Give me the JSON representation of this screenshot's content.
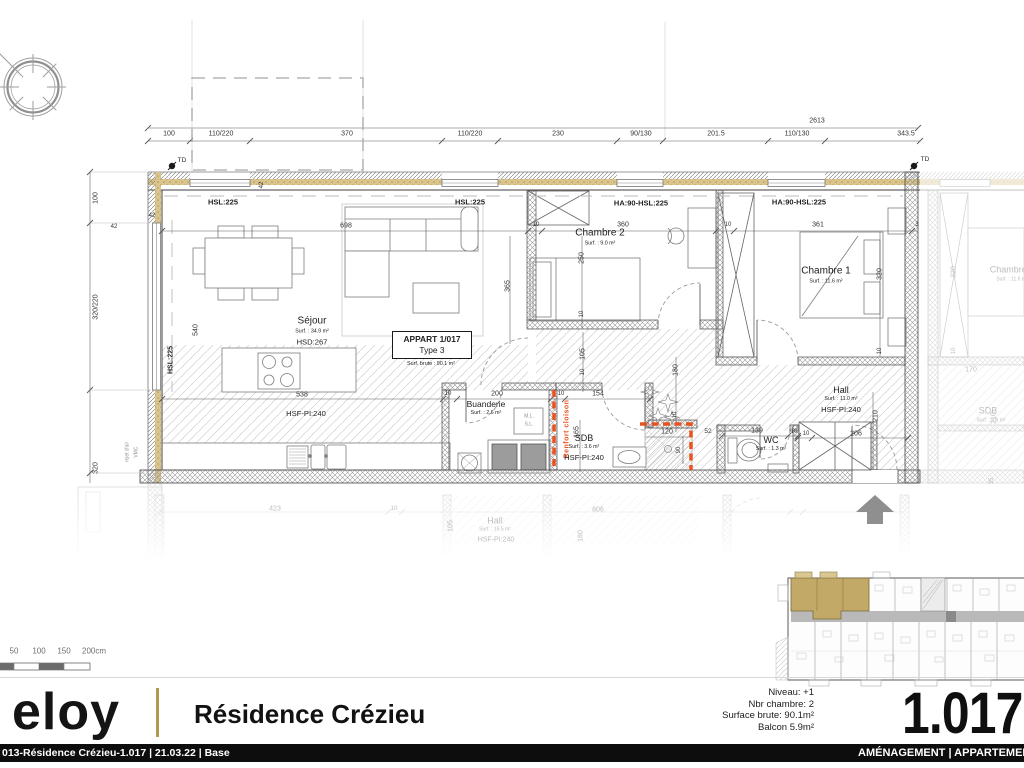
{
  "colors": {
    "accent_red": "#e8521f",
    "insulation": "#d8c48c",
    "keyplan_gold": "#c2a968",
    "title_gold": "#b09a52"
  },
  "plan": {
    "appart_box": {
      "line1": "APPART 1/017",
      "line2": "Type 3",
      "line3": "Surf. brute : 90.1 m²"
    },
    "rooms": [
      {
        "id": "sejour",
        "name": "Séjour",
        "surface": "Surf. : 34.9 m²",
        "extra": "HSD:267",
        "x": 312,
        "y": 331,
        "ns": 10
      },
      {
        "id": "chambre2",
        "name": "Chambre 2",
        "surface": "Surf. : 9.0 m²",
        "x": 600,
        "y": 237,
        "ns": 10
      },
      {
        "id": "chambre1",
        "name": "Chambre 1",
        "surface": "Surf. : 11.6 m²",
        "x": 826,
        "y": 275,
        "ns": 10
      },
      {
        "id": "buanderie",
        "name": "Buanderie",
        "surface": "Surf. : 2.6 m²",
        "x": 486,
        "y": 408,
        "ns": 8.5
      },
      {
        "id": "sdb",
        "name": "SDB",
        "surface": "Surf. : 3.6 m²",
        "extra": "HSF-PI:240",
        "x": 584,
        "y": 448,
        "ns": 9
      },
      {
        "id": "wc",
        "name": "WC",
        "surface": "Surf. : 1.3 m²",
        "x": 771,
        "y": 444,
        "ns": 9
      },
      {
        "id": "hall",
        "name": "Hall",
        "surface": "Surf. : 11.0 m²",
        "extra": "HSF-PI:240",
        "x": 841,
        "y": 400,
        "ns": 9
      }
    ],
    "window_labels": [
      {
        "t": "HSL:225",
        "x": 223,
        "y": 202,
        "s": 7.5
      },
      {
        "t": "HSL:225",
        "x": 470,
        "y": 202,
        "s": 7.5
      },
      {
        "t": "HA:90-HSL:225",
        "x": 641,
        "y": 203,
        "s": 7.5
      },
      {
        "t": "HA:90-HSL:225",
        "x": 799,
        "y": 202,
        "s": 7.5
      },
      {
        "t": "HSL:225",
        "x": 171,
        "y": 360,
        "r": -90,
        "s": 7
      }
    ],
    "dim_labels": [
      {
        "t": "100",
        "x": 169,
        "y": 134
      },
      {
        "t": "110/220",
        "x": 221,
        "y": 134
      },
      {
        "t": "370",
        "x": 347,
        "y": 134
      },
      {
        "t": "110/220",
        "x": 470,
        "y": 134
      },
      {
        "t": "230",
        "x": 558,
        "y": 134
      },
      {
        "t": "90/130",
        "x": 641,
        "y": 134
      },
      {
        "t": "201.5",
        "x": 716,
        "y": 134
      },
      {
        "t": "110/130",
        "x": 797,
        "y": 134
      },
      {
        "t": "343.5",
        "x": 906,
        "y": 134
      },
      {
        "t": "2613",
        "x": 817,
        "y": 121
      },
      {
        "t": "100",
        "x": 96,
        "y": 198,
        "r": -90
      },
      {
        "t": "320/220",
        "x": 96,
        "y": 307,
        "r": -90
      },
      {
        "t": "320",
        "x": 96,
        "y": 468,
        "r": -90
      },
      {
        "t": "42",
        "x": 114,
        "y": 227,
        "s": 6
      },
      {
        "t": "42",
        "x": 152,
        "y": 216,
        "s": 6
      },
      {
        "t": "42",
        "x": 262,
        "y": 185,
        "r": -90,
        "s": 6
      },
      {
        "t": "698",
        "x": 346,
        "y": 226
      },
      {
        "t": "540",
        "x": 196,
        "y": 330,
        "r": -90
      },
      {
        "t": "365",
        "x": 508,
        "y": 286,
        "r": -90
      },
      {
        "t": "538",
        "x": 302,
        "y": 395
      },
      {
        "t": "10",
        "x": 448,
        "y": 394,
        "s": 6
      },
      {
        "t": "200",
        "x": 497,
        "y": 394
      },
      {
        "t": "10",
        "x": 561,
        "y": 394,
        "s": 6
      },
      {
        "t": "154",
        "x": 598,
        "y": 394
      },
      {
        "t": "10",
        "x": 536,
        "y": 225,
        "s": 6
      },
      {
        "t": "360",
        "x": 623,
        "y": 225
      },
      {
        "t": "250",
        "x": 582,
        "y": 258,
        "r": -90
      },
      {
        "t": "10",
        "x": 582,
        "y": 314,
        "r": -90,
        "s": 6
      },
      {
        "t": "105",
        "x": 583,
        "y": 354,
        "r": -90
      },
      {
        "t": "10",
        "x": 583,
        "y": 372,
        "r": -90,
        "s": 6
      },
      {
        "t": "165",
        "x": 577,
        "y": 432,
        "r": -90
      },
      {
        "t": "120",
        "x": 667,
        "y": 432
      },
      {
        "t": "90",
        "x": 679,
        "y": 450,
        "r": -90,
        "s": 6
      },
      {
        "t": "52",
        "x": 708,
        "y": 432,
        "s": 6.5
      },
      {
        "t": "139",
        "x": 757,
        "y": 431
      },
      {
        "t": "10",
        "x": 794,
        "y": 432,
        "s": 6
      },
      {
        "t": "180",
        "x": 676,
        "y": 370,
        "r": -90
      },
      {
        "t": "10",
        "x": 675,
        "y": 415,
        "r": -90,
        "s": 6
      },
      {
        "t": "10",
        "x": 728,
        "y": 225,
        "s": 6
      },
      {
        "t": "361",
        "x": 818,
        "y": 225
      },
      {
        "t": "3",
        "x": 917,
        "y": 225,
        "s": 6
      },
      {
        "t": "320",
        "x": 880,
        "y": 274,
        "r": -90
      },
      {
        "t": "10",
        "x": 880,
        "y": 351,
        "r": -90,
        "s": 6
      },
      {
        "t": "206",
        "x": 856,
        "y": 434
      },
      {
        "t": "10",
        "x": 806,
        "y": 434,
        "s": 6
      },
      {
        "t": "210",
        "x": 876,
        "y": 416,
        "r": -90
      }
    ],
    "annotations": [
      {
        "t": "TD",
        "x": 182,
        "y": 161,
        "s": 6.5
      },
      {
        "t": "TD",
        "x": 925,
        "y": 160,
        "s": 6.5
      },
      {
        "t": "Renfort cloison",
        "x": 567,
        "y": 429,
        "r": -90,
        "s": 7,
        "c": "accent"
      },
      {
        "t": "rejet d'air",
        "x": 128,
        "y": 452,
        "r": -90,
        "s": 5,
        "c": "gray"
      },
      {
        "t": "VMC",
        "x": 137,
        "y": 452,
        "r": -90,
        "s": 5,
        "c": "gray"
      },
      {
        "t": "M.L.",
        "x": 529,
        "y": 417,
        "s": 5,
        "c": "gray"
      },
      {
        "t": "S.L.",
        "x": 529,
        "y": 425,
        "s": 5,
        "c": "gray"
      },
      {
        "t": "HSF-PI:240",
        "x": 306,
        "y": 414,
        "s": 7.6,
        "c": "room"
      }
    ],
    "neighbor_labels": [
      {
        "t": "Chambre 1",
        "x": 1012,
        "y": 270,
        "s": 9
      },
      {
        "t": "Surf. : 11.6 m²",
        "x": 1012,
        "y": 280,
        "s": 5
      },
      {
        "t": "320",
        "x": 954,
        "y": 272,
        "r": -90
      },
      {
        "t": "10",
        "x": 954,
        "y": 351,
        "r": -90,
        "s": 6
      },
      {
        "t": "170",
        "x": 971,
        "y": 370
      },
      {
        "t": "210",
        "x": 994,
        "y": 418,
        "r": -90
      },
      {
        "t": "SDB",
        "x": 988,
        "y": 411,
        "s": 9
      },
      {
        "t": "Surf. : 3.6 m²",
        "x": 991,
        "y": 421,
        "s": 5
      },
      {
        "t": "35",
        "x": 992,
        "y": 481,
        "r": -90,
        "s": 6
      }
    ],
    "lower_labels": [
      {
        "t": "423",
        "x": 275,
        "y": 509
      },
      {
        "t": "10",
        "x": 394,
        "y": 509,
        "s": 6
      },
      {
        "t": "806",
        "x": 598,
        "y": 510
      },
      {
        "t": "105",
        "x": 451,
        "y": 526,
        "r": -90
      },
      {
        "t": "180",
        "x": 581,
        "y": 536,
        "r": -90
      },
      {
        "t": "Hall",
        "x": 495,
        "y": 521,
        "s": 9
      },
      {
        "t": "Surf. : 15.5 m²",
        "x": 495,
        "y": 530,
        "s": 5
      },
      {
        "t": "HSF-PI:240",
        "x": 496,
        "y": 540,
        "s": 7
      }
    ]
  },
  "scalebar": {
    "labels": [
      "50",
      "100",
      "150",
      "200cm"
    ]
  },
  "titleblock": {
    "logo": "eloy",
    "project": "Résidence Crézieu",
    "info": [
      "Niveau: +1",
      "Nbr chambre: 2",
      "Surface brute: 90.1m²",
      "Balcon 5.9m²"
    ],
    "plan_number": "1.017"
  },
  "footer": {
    "left": "013-Résidence Crézieu-1.017 | 21.03.22 | Base",
    "right": "AMÉNAGEMENT | APPARTEMENT"
  }
}
